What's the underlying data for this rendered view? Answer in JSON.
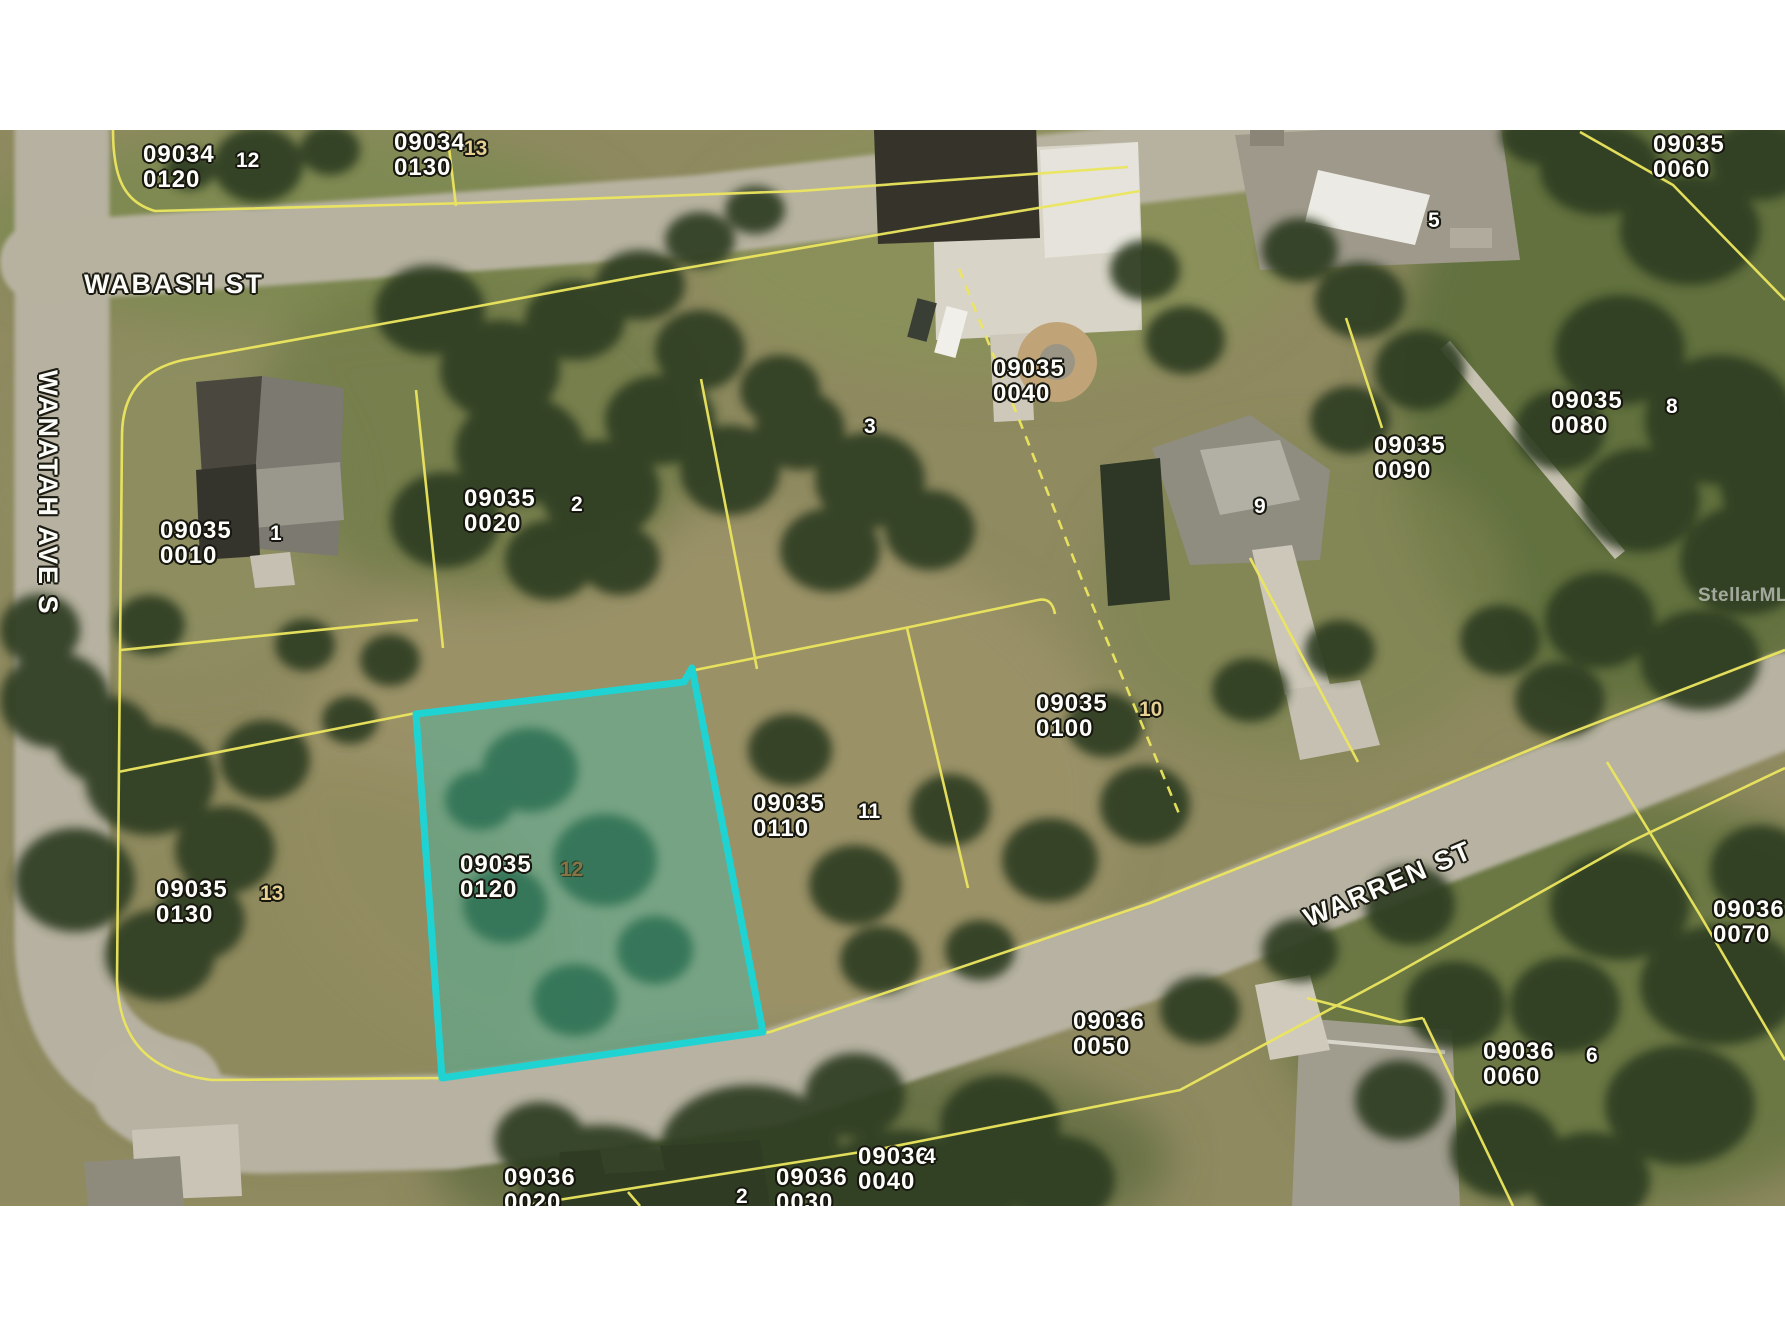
{
  "watermark": "StellarMLS",
  "streets": {
    "wabash": "WABASH ST",
    "wanatah": "WANATAH AVE S",
    "warren": "WARREN ST"
  },
  "colors": {
    "highlight_outline": "#1fd3d3",
    "highlight_fill": "rgba(35,205,200,0.30)",
    "parcel_line": "#ece65e",
    "label_text": "#ffffff"
  },
  "parcel_labels": [
    {
      "line1": "09034",
      "line2": "0120"
    },
    {
      "line1": "09034",
      "line2": "0130"
    },
    {
      "line1": "09035",
      "line2": "0060"
    },
    {
      "line1": "09035",
      "line2": "0010"
    },
    {
      "line1": "09035",
      "line2": "0020"
    },
    {
      "line1": "09035",
      "line2": "0040"
    },
    {
      "line1": "09035",
      "line2": "0080"
    },
    {
      "line1": "09035",
      "line2": "0090"
    },
    {
      "line1": "09035",
      "line2": "0100"
    },
    {
      "line1": "09035",
      "line2": "0110"
    },
    {
      "line1": "09035",
      "line2": "0120"
    },
    {
      "line1": "09035",
      "line2": "0130"
    },
    {
      "line1": "09036",
      "line2": "0070"
    },
    {
      "line1": "09036",
      "line2": "0060"
    },
    {
      "line1": "09036",
      "line2": "0050"
    },
    {
      "line1": "09036",
      "line2": "0020"
    },
    {
      "line1": "09036",
      "line2": "0030"
    },
    {
      "line1": "09036",
      "line2": "0040"
    }
  ],
  "lot_numbers": [
    {
      "n": "12"
    },
    {
      "n": "13"
    },
    {
      "n": "1"
    },
    {
      "n": "2"
    },
    {
      "n": "3"
    },
    {
      "n": "5"
    },
    {
      "n": "8"
    },
    {
      "n": "9"
    },
    {
      "n": "10"
    },
    {
      "n": "11"
    },
    {
      "n": "12"
    },
    {
      "n": "13"
    },
    {
      "n": "6"
    },
    {
      "n": "2"
    },
    {
      "n": "4"
    }
  ]
}
